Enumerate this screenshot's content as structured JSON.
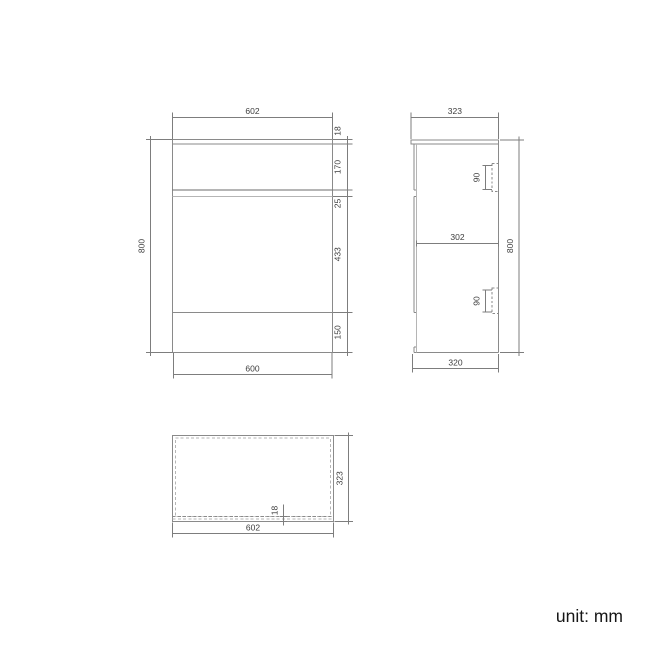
{
  "unit_label": "unit: mm",
  "front": {
    "width_top": "602",
    "top_thickness": "18",
    "drawer_height": "170",
    "gap": "25",
    "door_height": "433",
    "plinth_height": "150",
    "height": "800",
    "width_bottom": "600"
  },
  "side": {
    "depth_top": "323",
    "handle_upper": "90",
    "handle_lower": "90",
    "inner_depth": "302",
    "height": "800",
    "depth_bottom": "320"
  },
  "plan": {
    "depth": "323",
    "front_thickness": "18",
    "width": "602"
  },
  "colors": {
    "line": "#8a8a8a",
    "line_dark": "#6b6b6b",
    "line_light": "#b5b5b5",
    "dim_line": "#7d7d7d",
    "text": "#3d3d3d",
    "unit_text": "#161616",
    "background": "#ffffff"
  }
}
